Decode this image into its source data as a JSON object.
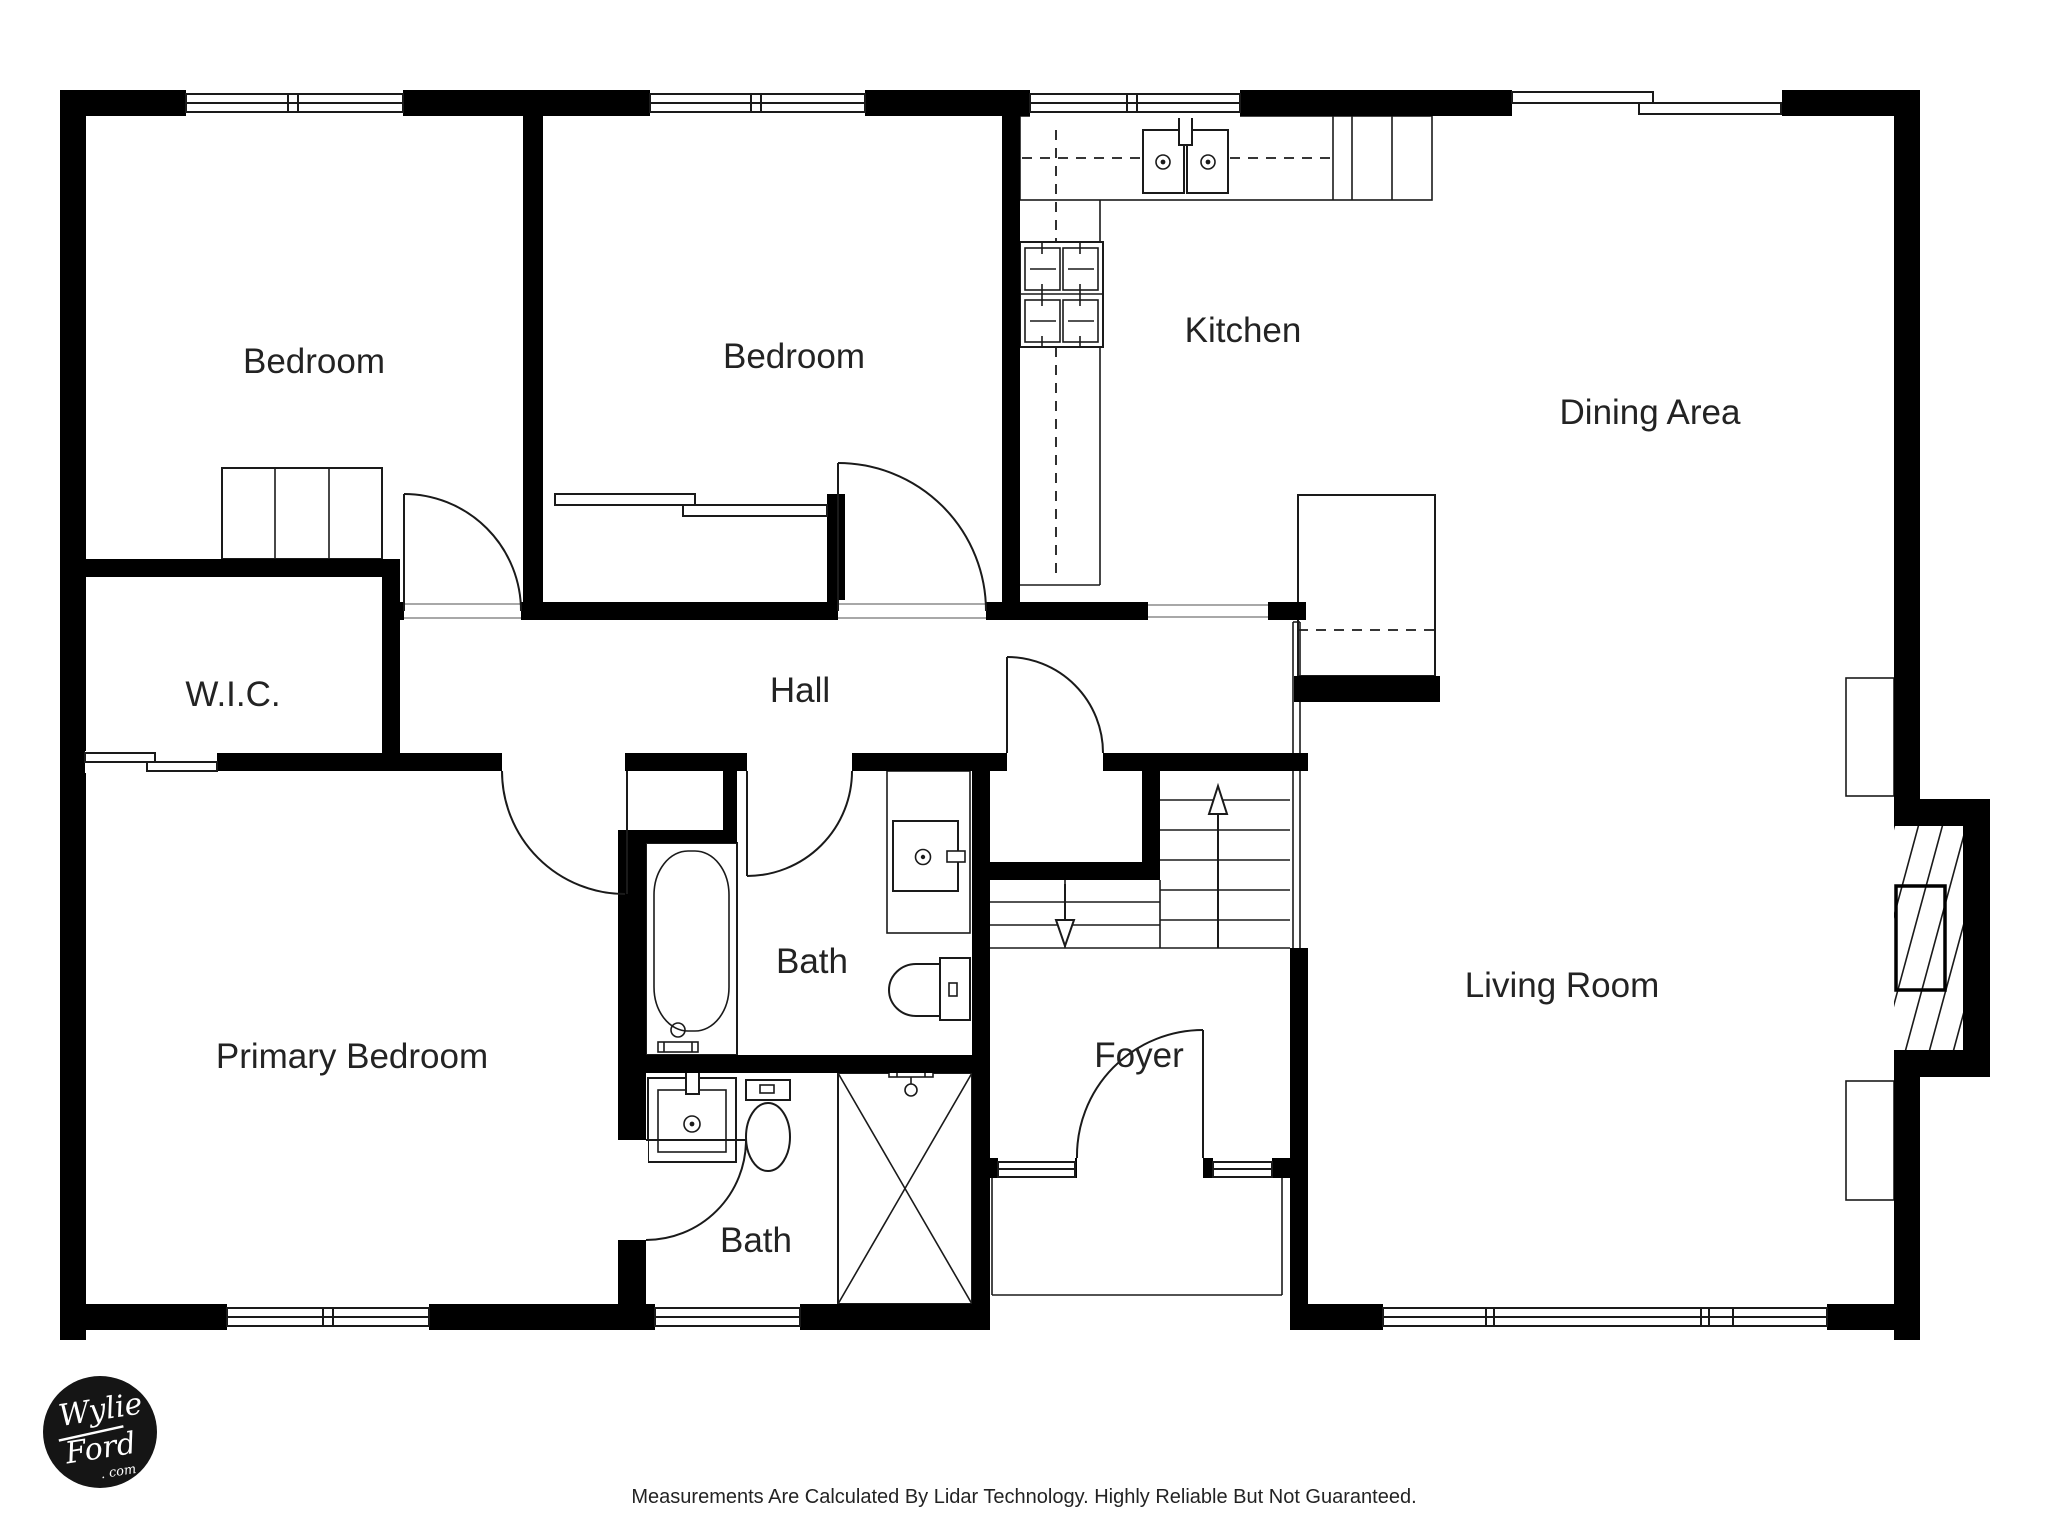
{
  "rooms": {
    "bedroom_left": "Bedroom",
    "bedroom_middle": "Bedroom",
    "kitchen": "Kitchen",
    "dining_area": "Dining Area",
    "wic": "W.I.C.",
    "hall": "Hall",
    "bath_hall": "Bath",
    "primary_bedroom": "Primary Bedroom",
    "bath_primary": "Bath",
    "foyer": "Foyer",
    "living_room": "Living Room"
  },
  "footer": {
    "disclaimer": "Measurements Are Calculated By Lidar Technology. Highly Reliable But Not Guaranteed."
  },
  "logo": {
    "line1": "Wylie",
    "line2": "Ford",
    "line3": ". com"
  },
  "colors": {
    "walls": "#000000",
    "background": "#ffffff",
    "label_text": "#232323",
    "footer_text": "#232323",
    "logo_background": "#151515",
    "logo_text": "#ffffff"
  }
}
